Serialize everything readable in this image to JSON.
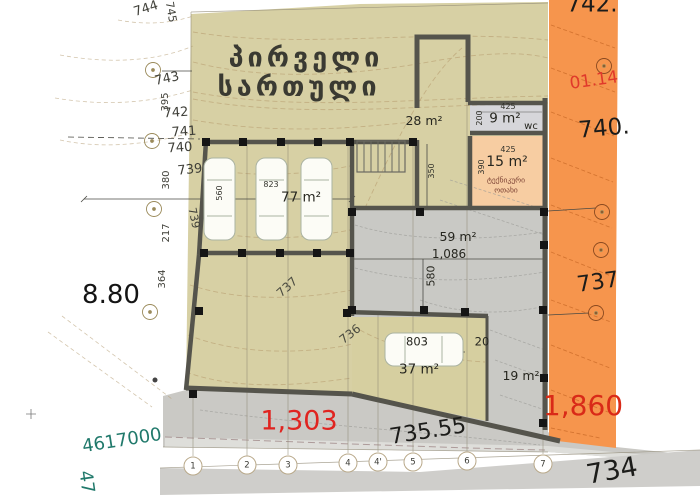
{
  "title": {
    "line1": "პირველი",
    "line2": "სართული"
  },
  "rooms": {
    "hall": {
      "area": "28 m²"
    },
    "wc": {
      "area": "9 m²",
      "label": "wc",
      "width": "425",
      "height": "200"
    },
    "technical": {
      "area": "15 m²",
      "name_line1": "ტექნიკური",
      "name_line2": "ოთახი",
      "width": "425",
      "height": "390"
    },
    "garage": {
      "area": "77 m²",
      "width": "823",
      "height": "560"
    },
    "terrace": {
      "area": "59 m²",
      "width": "1,086",
      "height": "580"
    },
    "lower": {
      "area": "37 m²",
      "width": "803",
      "offset": "20"
    },
    "yard": {
      "area": "19 m²"
    },
    "stair_dim": "350"
  },
  "elevations": {
    "top_right": "742.",
    "right_upper": "740.",
    "right_mid": "737",
    "road": "735.55",
    "bottom_right": "734",
    "left_spot": "8.80"
  },
  "parcel": {
    "code": "01.14",
    "area_right": "1,860",
    "area_road": "1,303"
  },
  "geo": {
    "northing": "4617000",
    "easting_partial": "47"
  },
  "contours": {
    "c744": "744",
    "c745": "745",
    "c743": "743",
    "c742": "742",
    "c741": "741",
    "c740": "740",
    "c739": "739",
    "c739b": "739",
    "c737": "737",
    "c736": "736",
    "d395": "395",
    "d380": "380",
    "d217": "217",
    "d364": "364"
  },
  "grid": {
    "bubbles": [
      "1",
      "2",
      "3",
      "4",
      "4'",
      "5",
      "6",
      "7"
    ]
  },
  "colors": {
    "plot_beige": "#d7d0a4",
    "parcel_orange": "#f6954d",
    "technical_peach": "#f7cda2",
    "wc_gray": "#d6d6da",
    "terrace_gray": "#c9c9c5",
    "road_gray": "#cac9c5",
    "wall_gray": "#55544c",
    "red_label": "#e02420",
    "green_label": "#20796b"
  }
}
